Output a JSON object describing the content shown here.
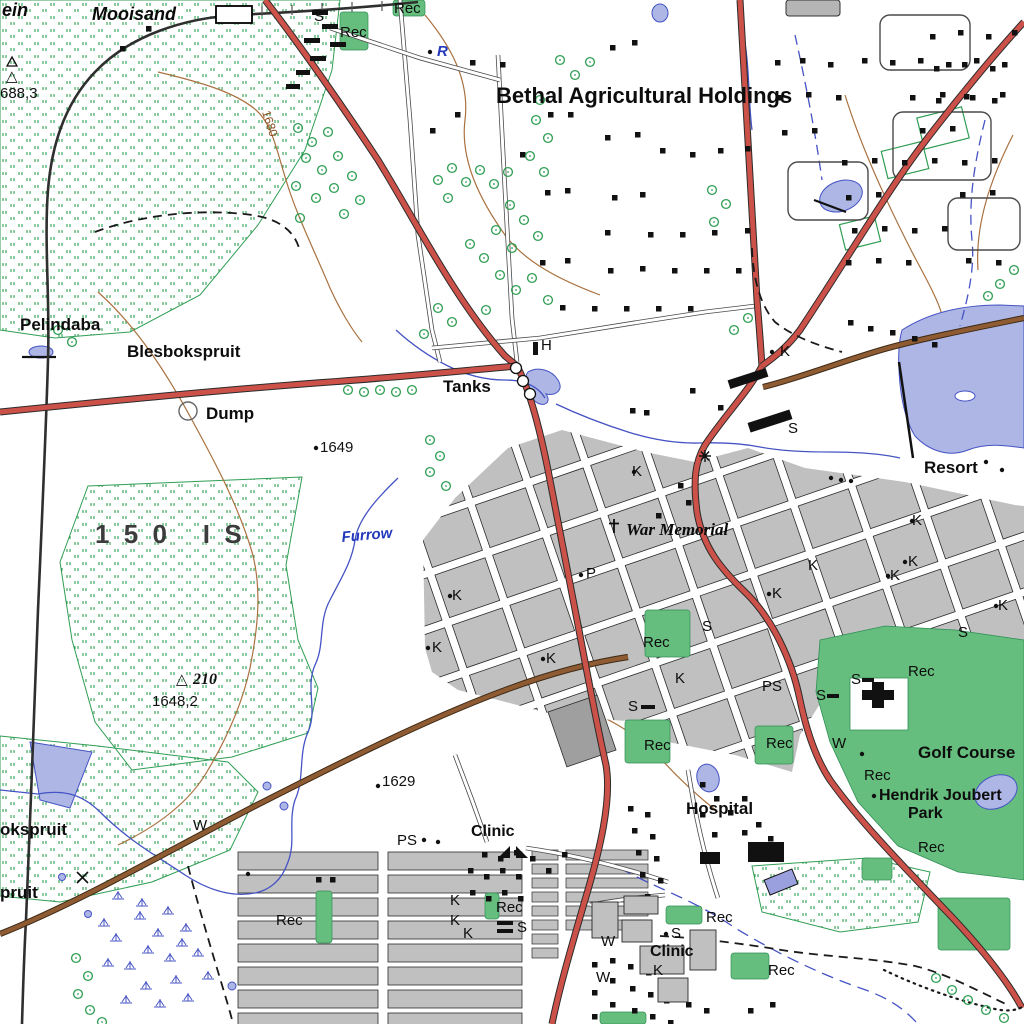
{
  "map": {
    "type": "topographic-map",
    "area_names": {
      "station": "Mooisand",
      "holdings": "Bethal Agricultural Holdings",
      "farm_portion": "150 IS",
      "places": [
        "Pelindaba",
        "Blesbokspruit",
        "Resort",
        "Hospital",
        "Golf Course",
        "Hendrik Joubert Park"
      ]
    }
  },
  "colors": {
    "background": "#FFFFFF",
    "road_major": "#CB5149",
    "road_secondary": "#8F5B33",
    "railway": "#2F2F2F",
    "water_fill": "#ADB6E4",
    "water_line": "#4553C4",
    "veld_stipple": "#2F9E53",
    "rec_green": "#66BE7E",
    "urban_block": "#C0C0C0",
    "urban_edge": "#2B2B2B",
    "contour": "#A9713F",
    "label_text": "#111111",
    "water_label": "#2438BB"
  },
  "labels": [
    {
      "text": "ein",
      "x": 2,
      "y": 16,
      "cls": "farm-name"
    },
    {
      "text": "Mooisand",
      "x": 92,
      "y": 20,
      "cls": "farm-name"
    },
    {
      "text": "S",
      "x": 314,
      "y": 21,
      "cls": "sym"
    },
    {
      "text": "Rec",
      "x": 394,
      "y": 13,
      "cls": "sym"
    },
    {
      "text": "Rec",
      "x": 340,
      "y": 37,
      "cls": "sym"
    },
    {
      "text": "R",
      "x": 437,
      "y": 56,
      "cls": "water-it"
    },
    {
      "text": "Bethal Agricultural Holdings",
      "x": 496,
      "y": 103,
      "cls": "place-lg"
    },
    {
      "text": "△",
      "x": 6,
      "y": 81,
      "cls": "spot"
    },
    {
      "text": "688,3",
      "x": 0,
      "y": 98,
      "cls": "spot"
    },
    {
      "text": "1680",
      "x": 262,
      "y": 112,
      "cls": "contour-lbl",
      "rot": 72
    },
    {
      "text": "Pelindaba",
      "x": 20,
      "y": 330,
      "cls": "place"
    },
    {
      "text": "Blesbokspruit",
      "x": 127,
      "y": 357,
      "cls": "place"
    },
    {
      "text": "Dump",
      "x": 206,
      "y": 419,
      "cls": "place"
    },
    {
      "text": "1649",
      "x": 320,
      "y": 452,
      "cls": "spot"
    },
    {
      "text": "Tanks",
      "x": 443,
      "y": 392,
      "cls": "place"
    },
    {
      "text": "H",
      "x": 541,
      "y": 350,
      "cls": "sym"
    },
    {
      "text": "150 IS",
      "x": 95,
      "y": 543,
      "cls": "farm150"
    },
    {
      "text": "Furrow",
      "x": 342,
      "y": 542,
      "cls": "water-it",
      "rot": -5
    },
    {
      "text": "K",
      "x": 632,
      "y": 476,
      "cls": "sym"
    },
    {
      "text": "War Memorial",
      "x": 626,
      "y": 535,
      "cls": "memorial"
    },
    {
      "text": "Resort",
      "x": 924,
      "y": 473,
      "cls": "place"
    },
    {
      "text": "K",
      "x": 780,
      "y": 356,
      "cls": "sym"
    },
    {
      "text": "S",
      "x": 788,
      "y": 433,
      "cls": "sym"
    },
    {
      "text": "K",
      "x": 912,
      "y": 525,
      "cls": "sym"
    },
    {
      "text": "P",
      "x": 586,
      "y": 578,
      "cls": "sym"
    },
    {
      "text": "K",
      "x": 452,
      "y": 600,
      "cls": "sym"
    },
    {
      "text": "K",
      "x": 432,
      "y": 652,
      "cls": "sym"
    },
    {
      "text": "K",
      "x": 546,
      "y": 663,
      "cls": "sym"
    },
    {
      "text": "K",
      "x": 808,
      "y": 570,
      "cls": "sym"
    },
    {
      "text": "K",
      "x": 908,
      "y": 566,
      "cls": "sym"
    },
    {
      "text": "K",
      "x": 890,
      "y": 580,
      "cls": "sym"
    },
    {
      "text": "K",
      "x": 772,
      "y": 598,
      "cls": "sym"
    },
    {
      "text": "K",
      "x": 998,
      "y": 610,
      "cls": "sym"
    },
    {
      "text": "S",
      "x": 702,
      "y": 631,
      "cls": "sym"
    },
    {
      "text": "S",
      "x": 958,
      "y": 637,
      "cls": "sym"
    },
    {
      "text": "Rec",
      "x": 643,
      "y": 647,
      "cls": "sym"
    },
    {
      "text": "K",
      "x": 675,
      "y": 683,
      "cls": "sym"
    },
    {
      "text": "S",
      "x": 628,
      "y": 711,
      "cls": "sym"
    },
    {
      "text": "PS",
      "x": 762,
      "y": 691,
      "cls": "sym"
    },
    {
      "text": "S",
      "x": 816,
      "y": 700,
      "cls": "sym"
    },
    {
      "text": "S",
      "x": 851,
      "y": 684,
      "cls": "sym"
    },
    {
      "text": "Rec",
      "x": 908,
      "y": 676,
      "cls": "sym"
    },
    {
      "text": "Rec",
      "x": 644,
      "y": 750,
      "cls": "sym"
    },
    {
      "text": "Rec",
      "x": 766,
      "y": 748,
      "cls": "sym"
    },
    {
      "text": "W",
      "x": 832,
      "y": 748,
      "cls": "sym"
    },
    {
      "text": "Golf Course",
      "x": 918,
      "y": 758,
      "cls": "place"
    },
    {
      "text": "Rec",
      "x": 864,
      "y": 780,
      "cls": "sym"
    },
    {
      "text": "Hendrik Joubert",
      "x": 879,
      "y": 800,
      "cls": "place-sm"
    },
    {
      "text": "Park",
      "x": 908,
      "y": 818,
      "cls": "place-sm"
    },
    {
      "text": "Rec",
      "x": 918,
      "y": 852,
      "cls": "sym"
    },
    {
      "text": "Hospital",
      "x": 686,
      "y": 814,
      "cls": "place"
    },
    {
      "text": "1629",
      "x": 382,
      "y": 786,
      "cls": "spot"
    },
    {
      "text": "△",
      "x": 176,
      "y": 684,
      "cls": "spot"
    },
    {
      "text": "210",
      "x": 193,
      "y": 684,
      "cls": "spot-it"
    },
    {
      "text": "1648,2",
      "x": 152,
      "y": 706,
      "cls": "spot"
    },
    {
      "text": "okspruit",
      "x": 0,
      "y": 835,
      "cls": "place"
    },
    {
      "text": "pruit",
      "x": 0,
      "y": 898,
      "cls": "place"
    },
    {
      "text": "W",
      "x": 193,
      "y": 830,
      "cls": "sym"
    },
    {
      "text": "Rec",
      "x": 276,
      "y": 925,
      "cls": "sym"
    },
    {
      "text": "PS",
      "x": 397,
      "y": 845,
      "cls": "sym"
    },
    {
      "text": "Clinic",
      "x": 471,
      "y": 836,
      "cls": "place-sm"
    },
    {
      "text": "K",
      "x": 450,
      "y": 905,
      "cls": "sym"
    },
    {
      "text": "K",
      "x": 450,
      "y": 925,
      "cls": "sym"
    },
    {
      "text": "K",
      "x": 463,
      "y": 938,
      "cls": "sym"
    },
    {
      "text": "Rec",
      "x": 496,
      "y": 912,
      "cls": "sym"
    },
    {
      "text": "S",
      "x": 517,
      "y": 932,
      "cls": "sym"
    },
    {
      "text": "W",
      "x": 601,
      "y": 946,
      "cls": "sym"
    },
    {
      "text": "W",
      "x": 596,
      "y": 982,
      "cls": "sym"
    },
    {
      "text": "S",
      "x": 671,
      "y": 938,
      "cls": "sym"
    },
    {
      "text": "Clinic",
      "x": 650,
      "y": 956,
      "cls": "place-sm"
    },
    {
      "text": "K",
      "x": 653,
      "y": 975,
      "cls": "sym"
    },
    {
      "text": "Rec",
      "x": 706,
      "y": 922,
      "cls": "sym"
    },
    {
      "text": "Rec",
      "x": 768,
      "y": 975,
      "cls": "sym"
    }
  ]
}
